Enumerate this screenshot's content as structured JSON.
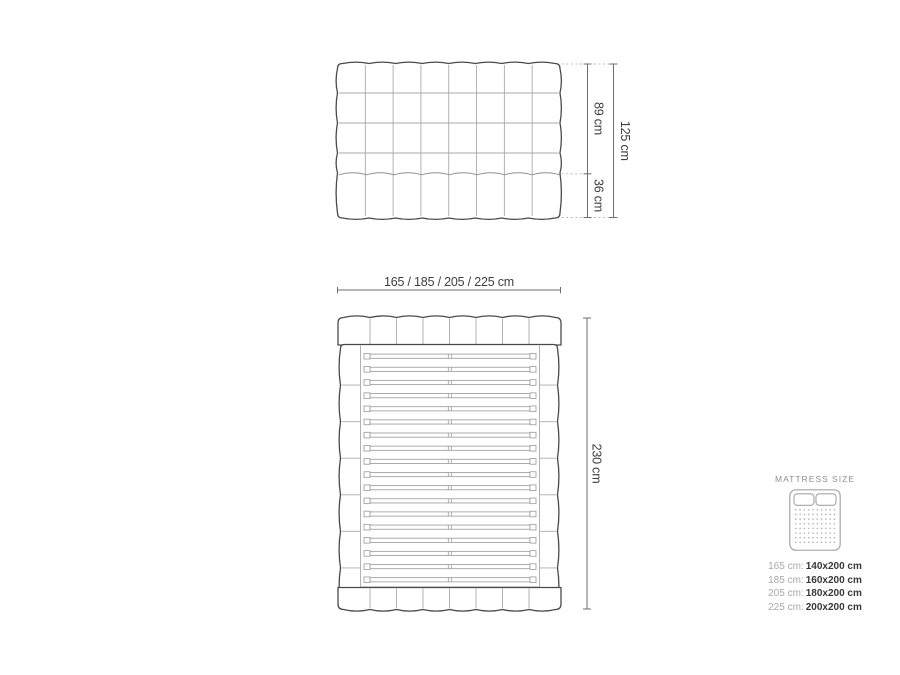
{
  "front_view": {
    "columns": 8,
    "upper_rows": 4,
    "lower_rows": 1,
    "height_upper_label": "89 cm",
    "height_lower_label": "36 cm",
    "height_total_label": "125 cm"
  },
  "top_view": {
    "headboard_cells": 8,
    "footboard_cells": 8,
    "slat_count": 18,
    "side_rail_segments": 7,
    "width_label": "165 / 185 / 205 / 225 cm",
    "length_label": "230 cm"
  },
  "legend": {
    "title": "MATTRESS SIZE",
    "rows": [
      {
        "frame": "165 cm:",
        "mattress": "140x200 cm"
      },
      {
        "frame": "185 cm:",
        "mattress": "160x200 cm"
      },
      {
        "frame": "205 cm:",
        "mattress": "180x200 cm"
      },
      {
        "frame": "225 cm:",
        "mattress": "200x200 cm"
      }
    ]
  },
  "colors": {
    "background": "#ffffff",
    "outline_dark": "#4a4a4a",
    "grid_light": "#aaaaaa",
    "tuft_line": "#8f8f8f",
    "dimension_line": "#6e6e6e",
    "dotted_leader": "#b8b8b8",
    "slat_line": "#9e9e9e",
    "label_text": "#3d3d3d",
    "legend_grey": "#a9a9a9",
    "legend_value": "#383838",
    "legend_icon": "#a5a5a5"
  }
}
